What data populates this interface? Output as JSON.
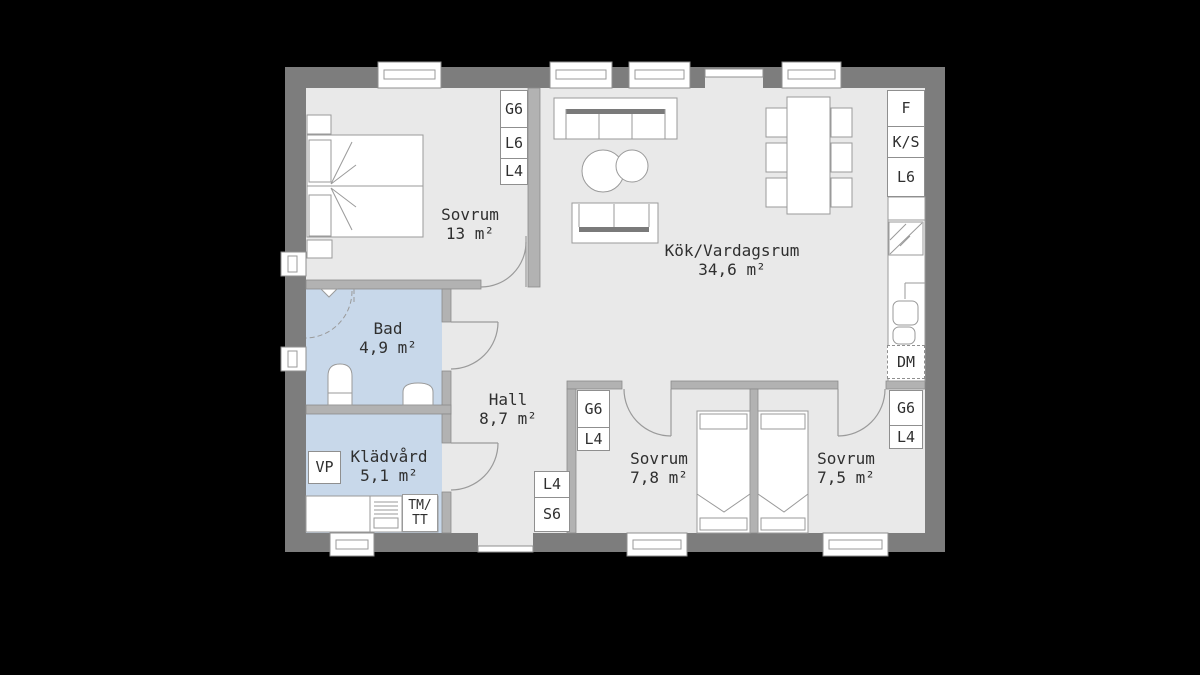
{
  "rooms": [
    {
      "id": "bedroom-1",
      "name": "Sovrum",
      "area": "13 m²"
    },
    {
      "id": "kitchen-living",
      "name": "Kök/Vardagsrum",
      "area": "34,6 m²"
    },
    {
      "id": "bathroom",
      "name": "Bad",
      "area": "4,9 m²"
    },
    {
      "id": "hall",
      "name": "Hall",
      "area": "8,7 m²"
    },
    {
      "id": "laundry",
      "name": "Klädvård",
      "area": "5,1 m²"
    },
    {
      "id": "bedroom-2",
      "name": "Sovrum",
      "area": "7,8 m²"
    },
    {
      "id": "bedroom-3",
      "name": "Sovrum",
      "area": "7,5 m²"
    }
  ],
  "wardrobes": {
    "bedroom1": [
      "G6",
      "L6",
      "L4"
    ],
    "bedroom2": [
      "G6",
      "L4"
    ],
    "bedroom3": [
      "G6",
      "L4"
    ],
    "hall": [
      "L4",
      "S6"
    ]
  },
  "kitchen": {
    "freezer": "F",
    "fridge_cooler": "K/S",
    "cabinet": "L6",
    "dishwasher": "DM"
  },
  "laundry": {
    "heat_pump": "VP",
    "washer_dryer_line1": "TM/",
    "washer_dryer_line2": "TT"
  },
  "colors": {
    "background": "#000000",
    "exterior_wall": "#7d7d7d",
    "interior_wall": "#b2b2b2",
    "interior_wall_edge": "#8b8b8b",
    "floor": "#e9e9e9",
    "wet_room_floor": "#c8d8ea",
    "furniture_line": "#9a9a9a",
    "sofa_back": "#7a7a7a",
    "label_text": "#2f2f2f"
  }
}
